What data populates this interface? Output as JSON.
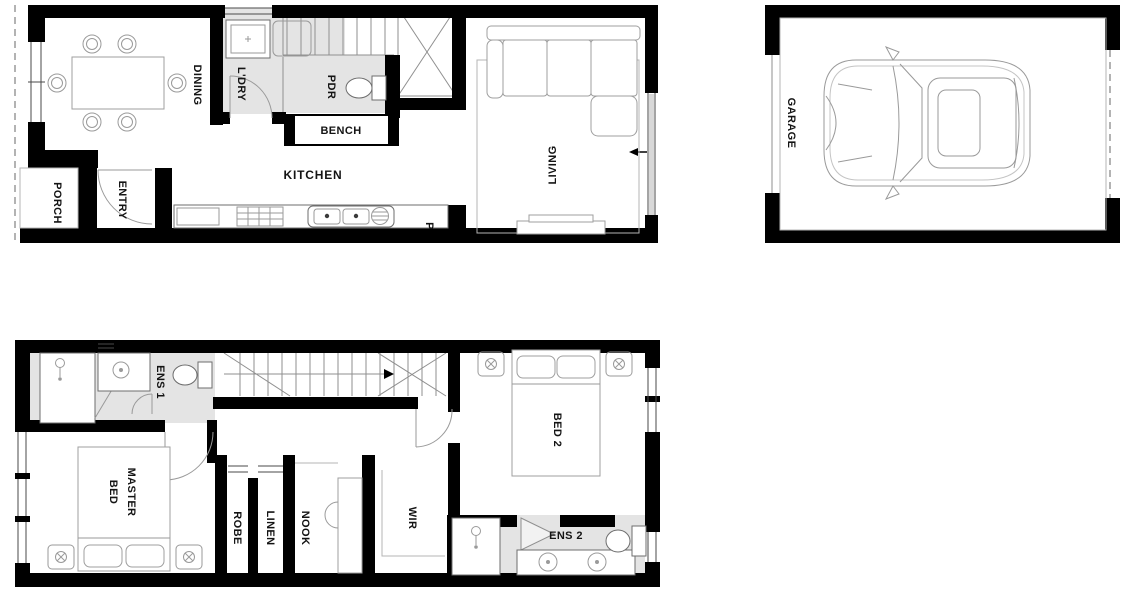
{
  "palette": {
    "background": "#ffffff",
    "wall": "#000000",
    "wet_area_fill": "#e4e4e4",
    "fixture_stroke": "#6e6e6e",
    "furniture_stroke": "#9f9f9f",
    "text": "#141414"
  },
  "floors": {
    "ground": {
      "porch": "PORCH",
      "entry": "ENTRY",
      "dining": "DINING",
      "laundry": "L'DRY",
      "powder": "PDR",
      "bench": "BENCH",
      "kitchen": "KITCHEN",
      "pantry": "P",
      "living": "LIVING"
    },
    "garage": {
      "garage": "GARAGE"
    },
    "upper": {
      "ens1": "ENS 1",
      "master_line1": "MASTER",
      "master_line2": "BED",
      "robe": "ROBE",
      "linen": "LINEN",
      "nook": "NOOK",
      "wir": "WIR",
      "bed2": "BED 2",
      "ens2": "ENS 2"
    }
  }
}
